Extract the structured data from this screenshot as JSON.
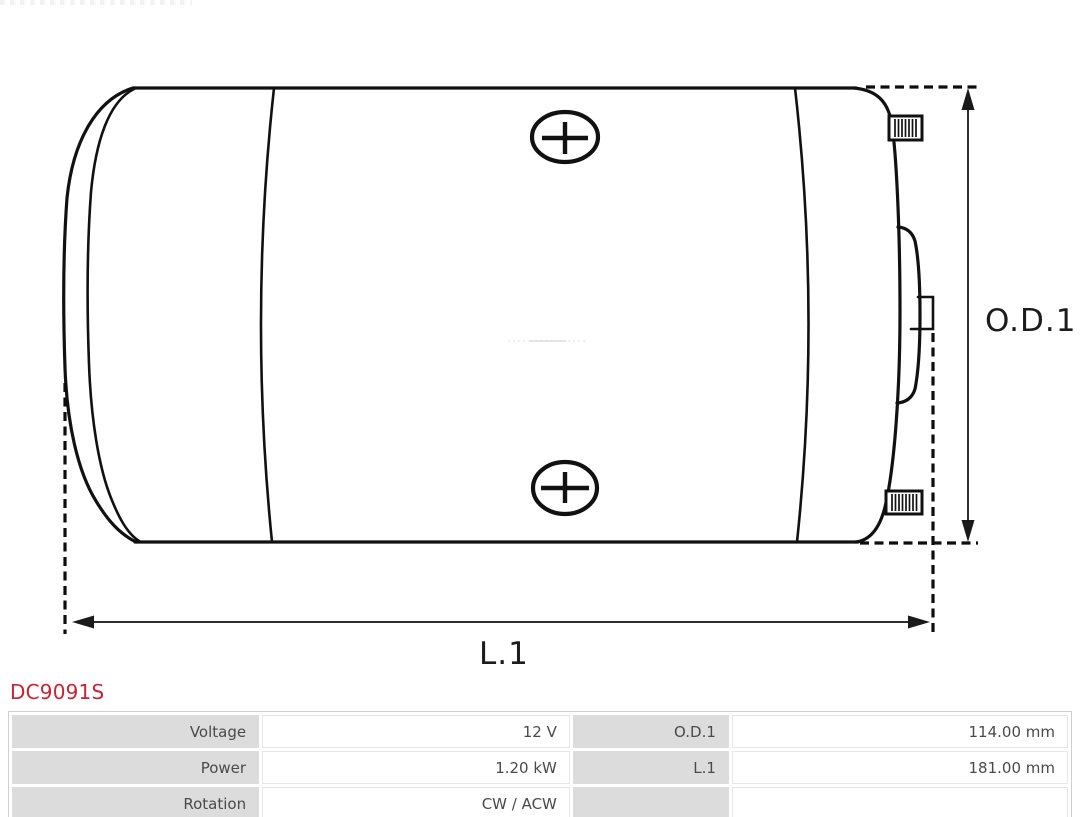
{
  "page": {
    "background": "#ffffff"
  },
  "part": {
    "number": "DC9091S",
    "number_color": "#cc2233"
  },
  "diagram": {
    "type": "technical-line-drawing",
    "subject": "starter-motor-side-view",
    "line_color": "#111111",
    "labels": {
      "od1": "O.D.1",
      "l1": "L.1"
    }
  },
  "spec_table": {
    "label_cell_bg": "#dcdcdc",
    "text_color": "#4a4a4a",
    "rows": [
      {
        "c1": "Voltage",
        "c2": "12 V",
        "c3": "O.D.1",
        "c4": "114.00 mm"
      },
      {
        "c1": "Power",
        "c2": "1.20 kW",
        "c3": "L.1",
        "c4": "181.00 mm"
      },
      {
        "c1": "Rotation",
        "c2": "CW / ACW",
        "c3": "",
        "c4": ""
      }
    ]
  }
}
